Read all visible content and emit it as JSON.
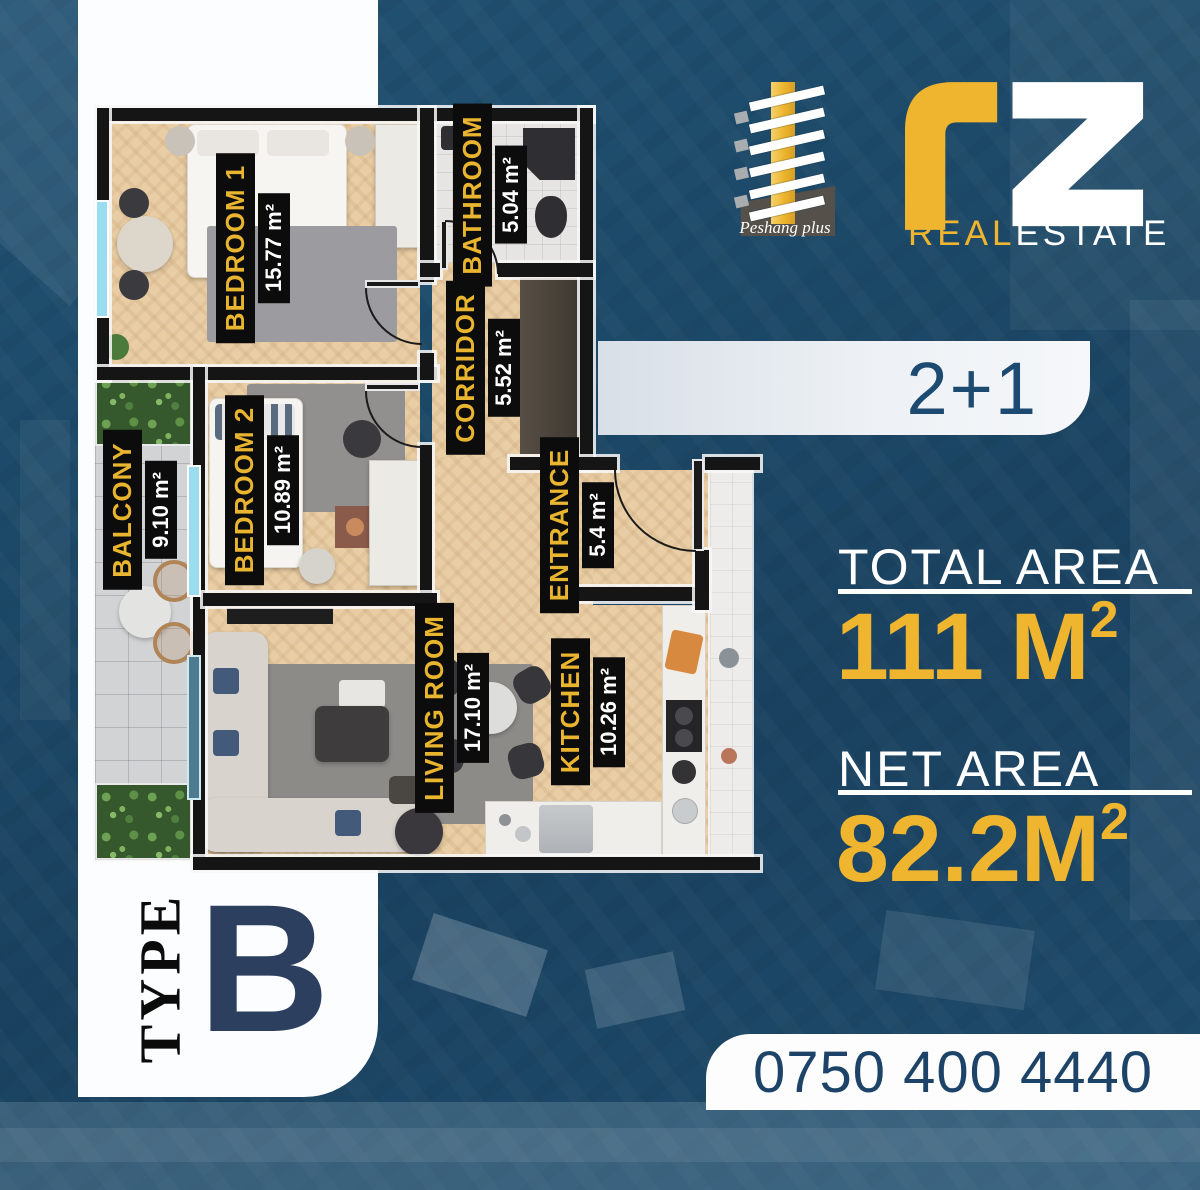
{
  "brand": {
    "rz_real": "REAL",
    "rz_estate": "ESTATE",
    "building_caption": "Peshang plus"
  },
  "badge": {
    "label": "2+1"
  },
  "areas": {
    "total_label": "TOTAL AREA",
    "total_value": "111 M",
    "total_sup": "2",
    "net_label": "NET AREA",
    "net_value": "82.2M",
    "net_sup": "2"
  },
  "type_panel": {
    "label": "TYPE",
    "value": "B"
  },
  "phone": "0750 400 4440",
  "floorplan": {
    "rooms": [
      {
        "name": "BEDROOM 1",
        "area": "15.77 m²"
      },
      {
        "name": "BATHROOM",
        "area": "5.04 m²"
      },
      {
        "name": "CORRIDOR",
        "area": "5.52 m²"
      },
      {
        "name": "BALCONY",
        "area": "9.10 m²"
      },
      {
        "name": "BEDROOM 2",
        "area": "10.89 m²"
      },
      {
        "name": "ENTRANCE",
        "area": "5.4 m²"
      },
      {
        "name": "LIVING ROOM",
        "area": "17.10 m²"
      },
      {
        "name": "KITCHEN",
        "area": "10.26 m²"
      }
    ]
  },
  "colors": {
    "background": "#1c4867",
    "navy_text": "#1d4a70",
    "gold": "#efb52f",
    "panel_white": "#fcfdfe",
    "badge_bg": "#e9edf2"
  }
}
